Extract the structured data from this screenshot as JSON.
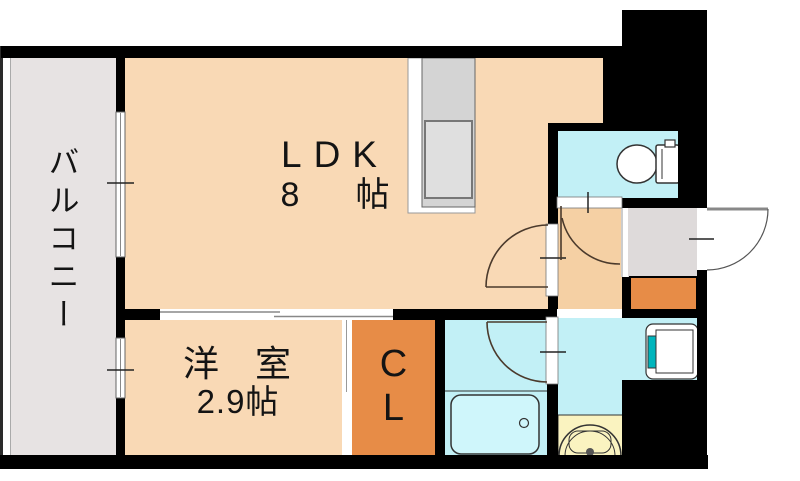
{
  "rooms": {
    "balcony": {
      "label": "バルコニー"
    },
    "ldk": {
      "label": "LDK",
      "size_value": "8",
      "size_unit": "帖"
    },
    "western_room": {
      "label": "洋 室",
      "size": "2.9帖"
    },
    "closet": {
      "label_line1": "C",
      "label_line2": "L"
    }
  },
  "fixtures": [
    "kitchen-counter",
    "kitchen-sink",
    "toilet",
    "bathtub",
    "washbasin",
    "washing-machine-pan",
    "entrance-door",
    "sliding-window",
    "sliding-door"
  ],
  "colors": {
    "wall": "#000000",
    "ldk_fill": "#F9D9B5",
    "hall_fill": "#F5D0A4",
    "orange_fill": "#E78C47",
    "cyan_fill": "#C2F0F6",
    "tub_fill": "#CFF6FB",
    "cream_fill": "#FAF3C0",
    "teal_accent": "#00B5BC",
    "balcony_fill": "#E7E3E3",
    "genkan_fill": "#DEDADA",
    "counter_fill": "#D4D4D4",
    "sink_fill": "#DFDFDF",
    "door_line": "#4B3A2C"
  }
}
